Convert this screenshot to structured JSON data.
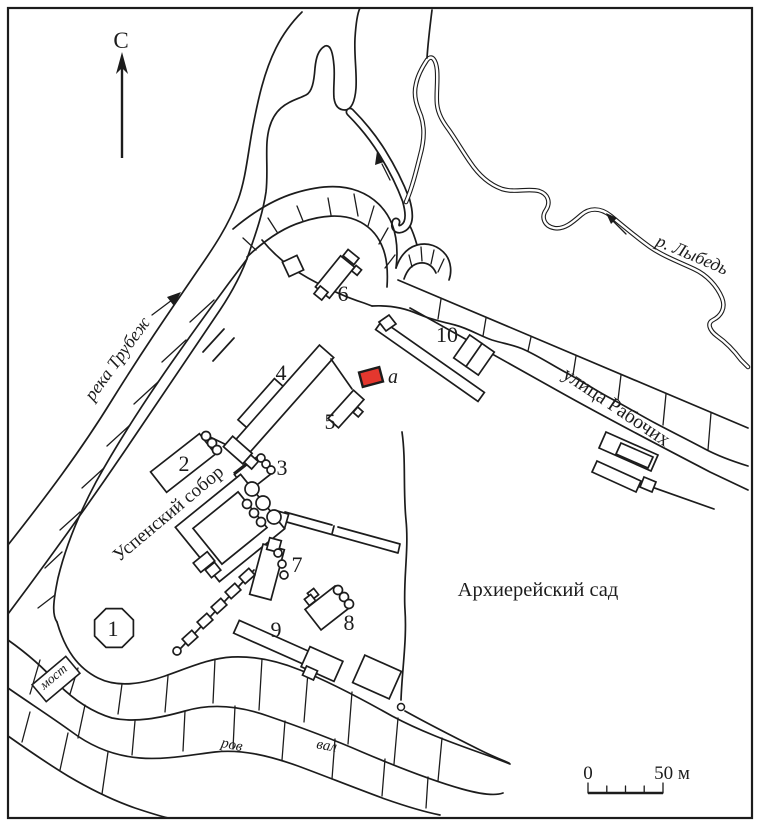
{
  "figure": {
    "type": "archaeological-site-plan",
    "north_label": "С"
  },
  "rivers": {
    "trubezh_label": "река Трубеж",
    "lybed_label": "р. Лыбедь"
  },
  "street": {
    "label": "улица Рабочих"
  },
  "areas": {
    "garden_label": "Архиерейский сад"
  },
  "features": {
    "cathedral_label": "Успенский собор",
    "bridge_label": "мост",
    "moat_label": "ров",
    "rampart_label": "вал",
    "excavation_label": "а"
  },
  "buildings": [
    {
      "number": "1"
    },
    {
      "number": "2"
    },
    {
      "number": "3"
    },
    {
      "number": "4"
    },
    {
      "number": "5"
    },
    {
      "number": "6"
    },
    {
      "number": "7"
    },
    {
      "number": "8"
    },
    {
      "number": "9"
    },
    {
      "number": "10"
    }
  ],
  "scale_bar": {
    "start": "0",
    "end": "50 м"
  },
  "colors": {
    "ink": "#1c1c1c",
    "excavation_fill": "#e4372e",
    "background": "#ffffff"
  }
}
